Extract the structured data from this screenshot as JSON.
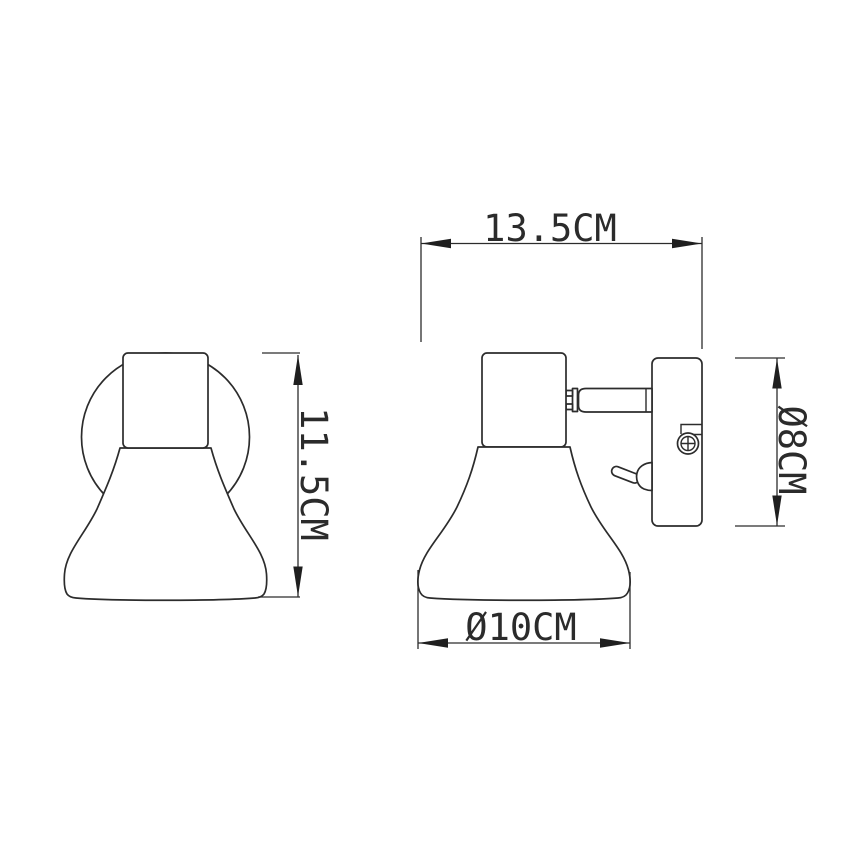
{
  "drawing": {
    "labels": {
      "width": "13.5CM",
      "height": "11.5CM",
      "plate_diameter": "Ø8CM",
      "shade_diameter": "Ø10CM"
    },
    "colors": {
      "line": "#2c2c2c",
      "arrow": "#1f1f1f",
      "background": "#ffffff"
    }
  }
}
